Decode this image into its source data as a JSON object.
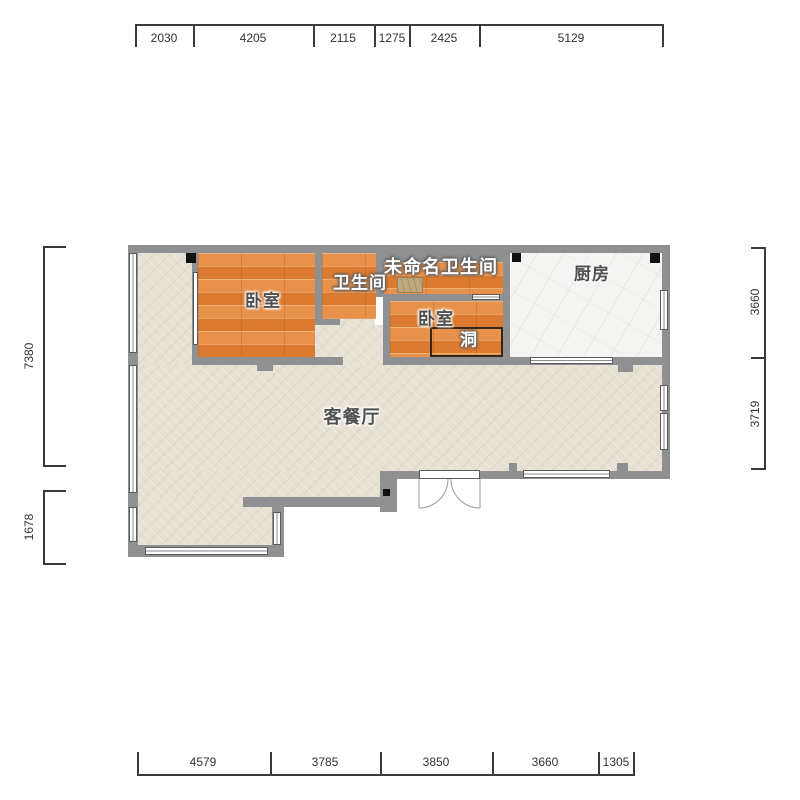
{
  "plan_title": "户型图",
  "rooms": {
    "bedroom1": "卧室",
    "bath1": "卫生间",
    "unnamed_bath": "未命名卫生间",
    "bedroom2": "卧室",
    "hole": "洞",
    "kitchen": "厨房",
    "living": "客餐厅"
  },
  "dims": {
    "top": [
      "2030",
      "4205",
      "2115",
      "1275",
      "2425",
      "5129"
    ],
    "bottom": [
      "4579",
      "3785",
      "3850",
      "3660",
      "1305"
    ],
    "left": [
      "7380",
      "1678"
    ],
    "right": [
      "3660",
      "3719"
    ]
  },
  "colors": {
    "wall": "#8f9091",
    "wood_floor": "#e2823a",
    "living_floor": "#e6e1d3",
    "kitchen_floor": "#f4f4f2",
    "pillar": "#121212",
    "fixture": "#bfa87e",
    "dimension_text": "#333333"
  }
}
